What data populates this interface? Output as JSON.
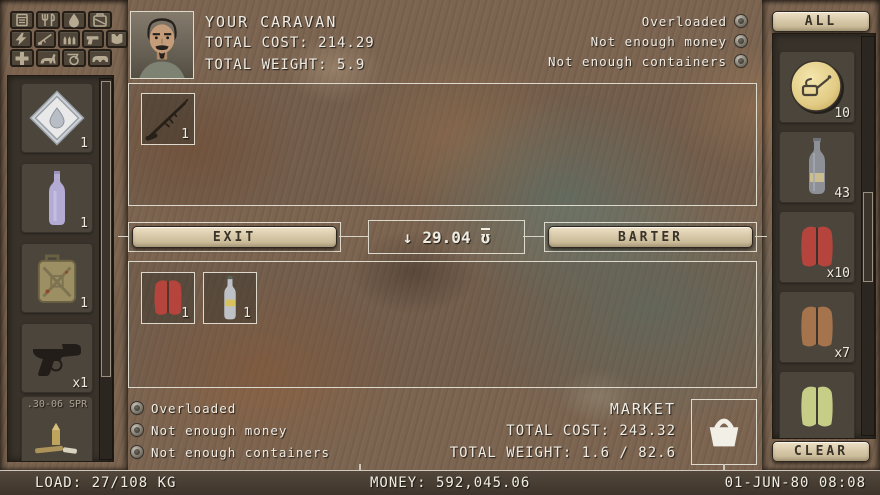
{
  "header": {
    "title": "YOUR CARAVAN",
    "total_cost": "TOTAL COST: 214.29",
    "total_weight": "TOTAL WEIGHT: 5.9"
  },
  "caravan_status": [
    "Overloaded",
    "Not enough money",
    "Not enough containers"
  ],
  "market_status": [
    "Overloaded",
    "Not enough money",
    "Not enough containers"
  ],
  "market": {
    "title": "MARKET",
    "total_cost": "TOTAL COST: 243.32",
    "total_weight": "TOTAL WEIGHT: 1.6 / 82.6"
  },
  "trade_bar": {
    "exit_label": "EXIT",
    "barter_label": "BARTER",
    "arrow": "↓",
    "amount": "29.04",
    "currency_symbol": "ʊ"
  },
  "caravan_offer": [
    {
      "item": "hunting-rifle",
      "qty": "1"
    }
  ],
  "market_offer": [
    {
      "item": "red-jacket",
      "qty": "1"
    },
    {
      "item": "glass-bottle",
      "qty": "1"
    }
  ],
  "player_goods": [
    {
      "item": "water-pouch",
      "qty": "1"
    },
    {
      "item": "lavender-bottle",
      "qty": "1"
    },
    {
      "item": "jerrycan",
      "qty": "1"
    },
    {
      "item": "luger-pistol",
      "qty": "x1"
    },
    {
      "item": "rifle-ammo",
      "label": ".30-06 SPR"
    }
  ],
  "market_goods": {
    "all_label": "ALL",
    "clear_label": "CLEAR",
    "items": [
      {
        "item": "oil-coin",
        "qty": "10"
      },
      {
        "item": "wine-bottle",
        "qty": "43"
      },
      {
        "item": "red-jacket",
        "qty": "x10",
        "color": "#b5443c"
      },
      {
        "item": "brown-jacket",
        "qty": "x7",
        "color": "#a5744c"
      },
      {
        "item": "green-jacket",
        "color": "#c6cd87"
      }
    ]
  },
  "filters": [
    "canned-food",
    "tools",
    "water",
    "fuel",
    "energy",
    "rifle",
    "ammo",
    "gun",
    "armor",
    "medicine",
    "animal",
    "cart",
    "vehicle"
  ],
  "status_bar": {
    "load": "LOAD: 27/108 KG",
    "money": "MONEY: 592,045.06",
    "datetime": "01-JUN-80 08:08"
  },
  "colors": {
    "button_face": "#d9cdb0",
    "panel_border": "#ded9cd",
    "coin_gold": "#e2cb84",
    "purple_bottle": "#b4abd4"
  }
}
